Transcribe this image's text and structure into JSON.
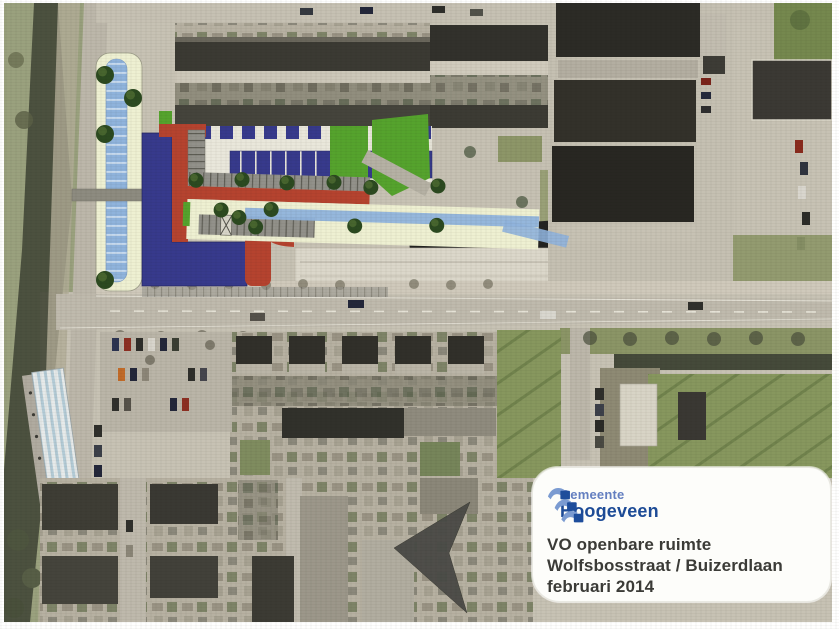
{
  "info_box": {
    "logo": {
      "municipality_label": "Gemeente",
      "municipality_name": "Hoogeveen"
    },
    "title_lines": [
      "VO openbare ruimte",
      "Wolfsbosstraat / Buizerdlaan",
      "februari 2014"
    ]
  },
  "colors": {
    "plan_water": "#8fb3dc",
    "plan_water_stripe": "#cfe0f2",
    "plan_deck_navy": "#373a8c",
    "plan_path_red": "#b5432f",
    "plan_pavement_cream": "#eef0d2",
    "plan_green": "#55a32d",
    "plan_parking_gray": "#92918a",
    "tree_green": "#2c4a20",
    "north_arrow_gray": "#4b4b47",
    "photo_road_gray": "#bfbaad",
    "photo_grass_olive": "#9aa17e",
    "photo_water_dark": "#454a3a",
    "photo_field_green": "#87975e",
    "photo_roof_dark": "#31302a",
    "logo_blue": "#1e4d9b",
    "logo_blue_light": "#7b9bd1",
    "title_text": "#3b3b37"
  }
}
